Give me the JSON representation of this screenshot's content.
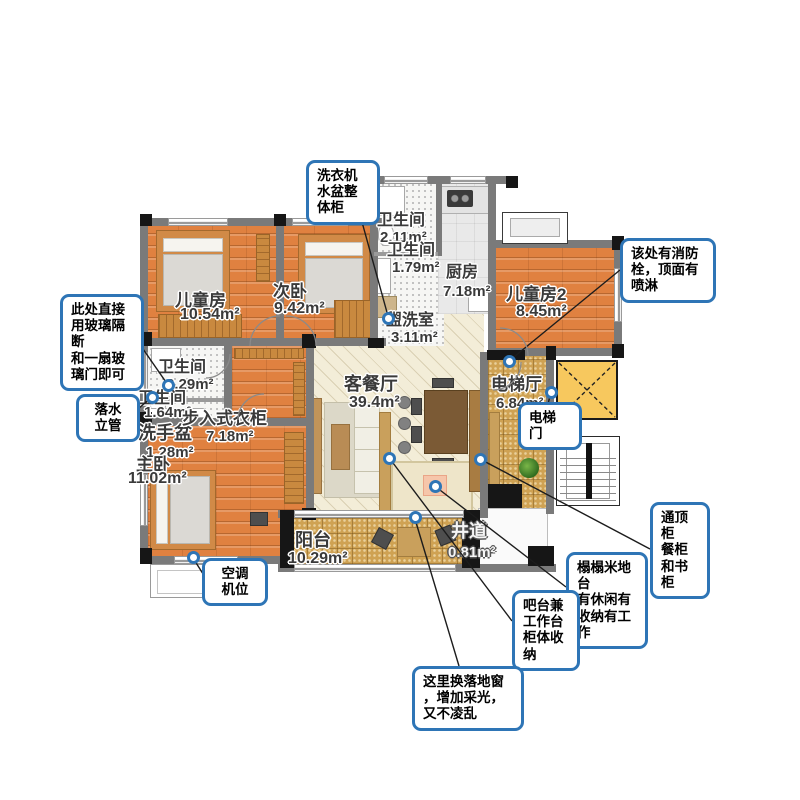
{
  "rooms": [
    {
      "name": "儿童房",
      "area": "10.54m²"
    },
    {
      "name": "次卧",
      "area": "9.42m²"
    },
    {
      "name": "卫生间",
      "area": "2.11m²"
    },
    {
      "name": "卫生间",
      "area": "1.79m²"
    },
    {
      "name": "厨房",
      "area": "7.18m²"
    },
    {
      "name": "儿童房2",
      "area": "8.45m²"
    },
    {
      "name": "盥洗室",
      "area": "3.11m²"
    },
    {
      "name": "客餐厅",
      "area": "39.4m²"
    },
    {
      "name": "电梯厅",
      "area": "6.84m²"
    },
    {
      "name": "卫生间",
      "area": "2.29m²"
    },
    {
      "name": "卫生间",
      "area": "1.64m²"
    },
    {
      "name": "洗手盆",
      "area": "1.28m²"
    },
    {
      "name": "步入式衣柜",
      "area": "7.18m²"
    },
    {
      "name": "主卧",
      "area": "11.02m²"
    },
    {
      "name": "阳台",
      "area": "10.29m²"
    },
    {
      "name": "井道",
      "area": "0.81m²"
    }
  ],
  "callouts": [
    {
      "id": "washer-cabinet",
      "text": "洗衣机\n水盆整\n体柜"
    },
    {
      "id": "fire-hydrant",
      "text": "该处有消防\n栓，顶面有\n喷淋"
    },
    {
      "id": "glass-partition",
      "text": "此处直接\n用玻璃隔\n断\n和一扇玻\n璃门即可"
    },
    {
      "id": "downpipe",
      "text": "落水\n立管"
    },
    {
      "id": "ac-unit",
      "text": "空调\n机位"
    },
    {
      "id": "elevator-door",
      "text": "电梯\n门"
    },
    {
      "id": "ceiling-cabinet",
      "text": "通顶\n柜\n餐柜\n和书\n柜"
    },
    {
      "id": "tatami",
      "text": "榻榻米地\n台\n有休闲有\n收纳有工\n作"
    },
    {
      "id": "bar-worktable",
      "text": "吧台兼\n工作台\n柜体收\n纳"
    },
    {
      "id": "floor-window",
      "text": "这里换落地窗\n，增加采光，\n又不凌乱"
    }
  ],
  "colors": {
    "callout_border": "#2e75b6",
    "wall": "#7a7a7a",
    "wood_floor": "#e08140",
    "tile_floor": "#cfa253",
    "living_floor": "#f3edd8",
    "elevator_shaft": "#f7c85e"
  }
}
